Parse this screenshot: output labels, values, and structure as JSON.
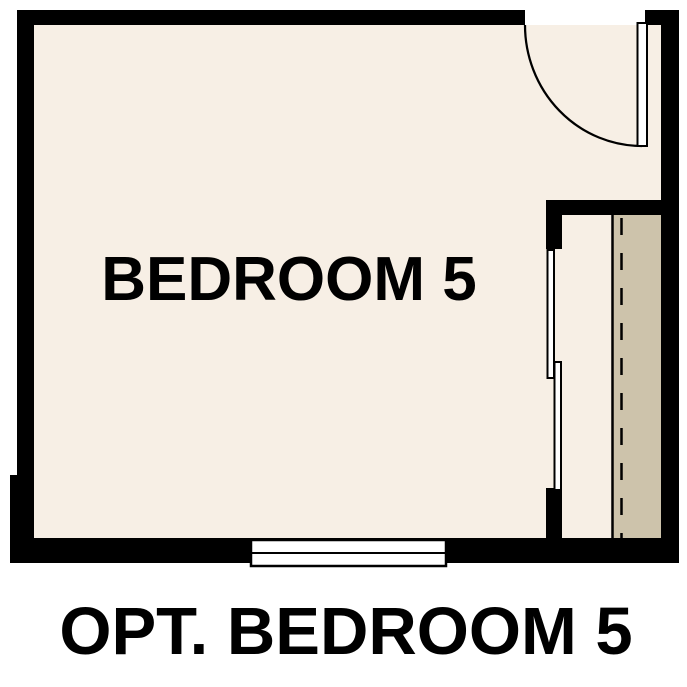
{
  "floorplan": {
    "room_label": "BEDROOM 5",
    "caption": "OPT. BEDROOM 5"
  },
  "colors": {
    "wall": "#000000",
    "line": "#000000",
    "floor": "#f7efe5",
    "shelf": "#cdc3ab",
    "fixture_white": "#ffffff",
    "text": "#000000",
    "background": "#ffffff"
  }
}
